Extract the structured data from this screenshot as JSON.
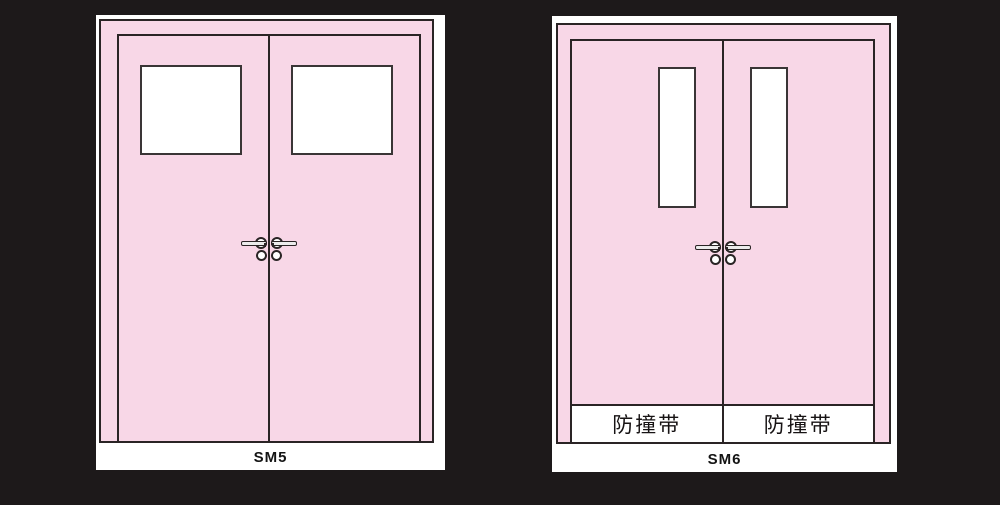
{
  "colors": {
    "background": "#1d191a",
    "door_pink": "#f8d7e7",
    "outline_dark": "#2a2425",
    "panel_white": "#ffffff"
  },
  "figures": [
    {
      "label": "SM5",
      "bumper_strips": []
    },
    {
      "label": "SM6",
      "bumper_strips": [
        "防撞带",
        "防撞带"
      ]
    }
  ],
  "icons": {
    "lever_handle": "horizontal-bar-with-round-rosette",
    "lock_cylinder": "small-circle-below-handle"
  }
}
